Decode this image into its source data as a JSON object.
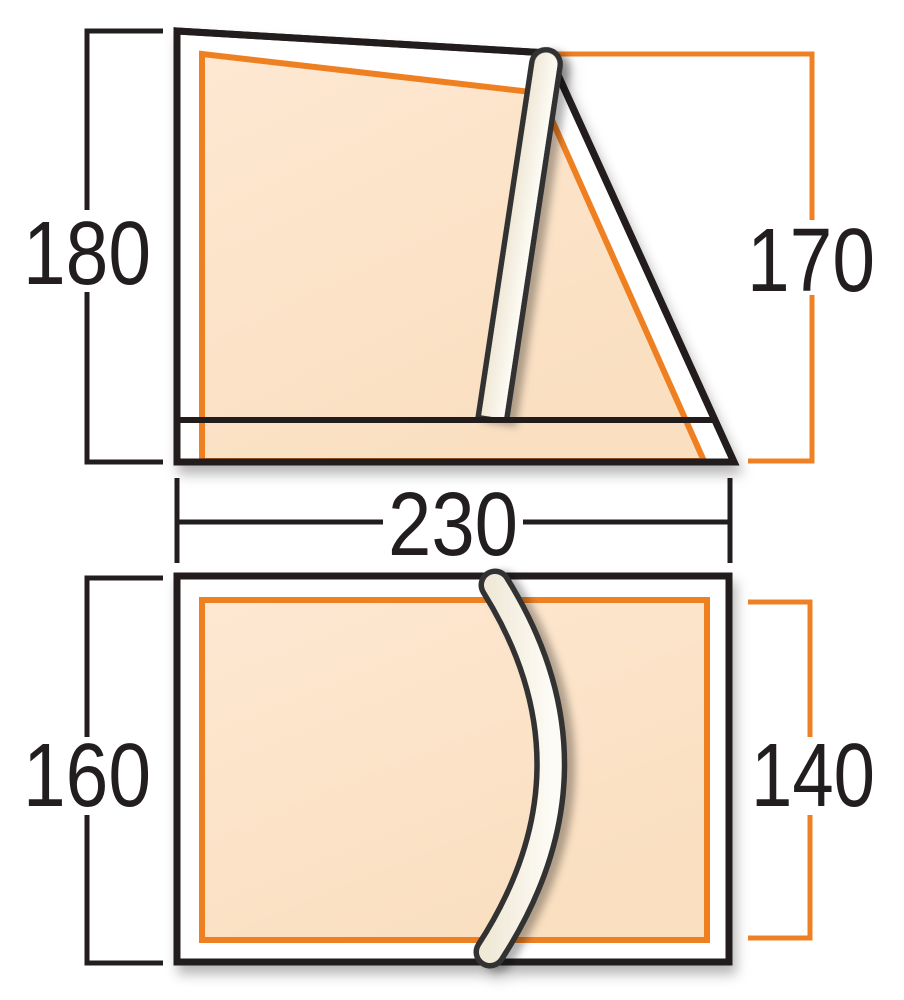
{
  "diagram": {
    "type": "tent-dimension-diagram",
    "views": [
      {
        "name": "side-profile",
        "description": "tent side elevation with upright pole",
        "dimensions": [
          {
            "value": "180",
            "side": "left",
            "measures": "outer tent height",
            "line_color": "#221e1f"
          },
          {
            "value": "170",
            "side": "right",
            "measures": "inner tent height",
            "line_color": "#ef8023"
          },
          {
            "value": "230",
            "side": "bottom",
            "measures": "tent width",
            "line_color": "#221e1f"
          }
        ]
      },
      {
        "name": "floor-plan",
        "description": "tent footprint with curved hoop pole",
        "dimensions": [
          {
            "value": "160",
            "side": "left",
            "measures": "outer floor depth",
            "line_color": "#221e1f"
          },
          {
            "value": "140",
            "side": "right",
            "measures": "inner floor depth",
            "line_color": "#ef8023"
          }
        ]
      }
    ]
  },
  "dims": {
    "side_outer_height": "180",
    "side_inner_height": "170",
    "width": "230",
    "plan_outer_depth": "160",
    "plan_inner_depth": "140"
  },
  "colors": {
    "outline_black": "#221e1f",
    "accent_orange": "#ef8023",
    "inner_fill_peach": "#fce3c8",
    "pole_cream": "#f5efe3",
    "pole_outline": "#333333",
    "background": "#ffffff"
  }
}
